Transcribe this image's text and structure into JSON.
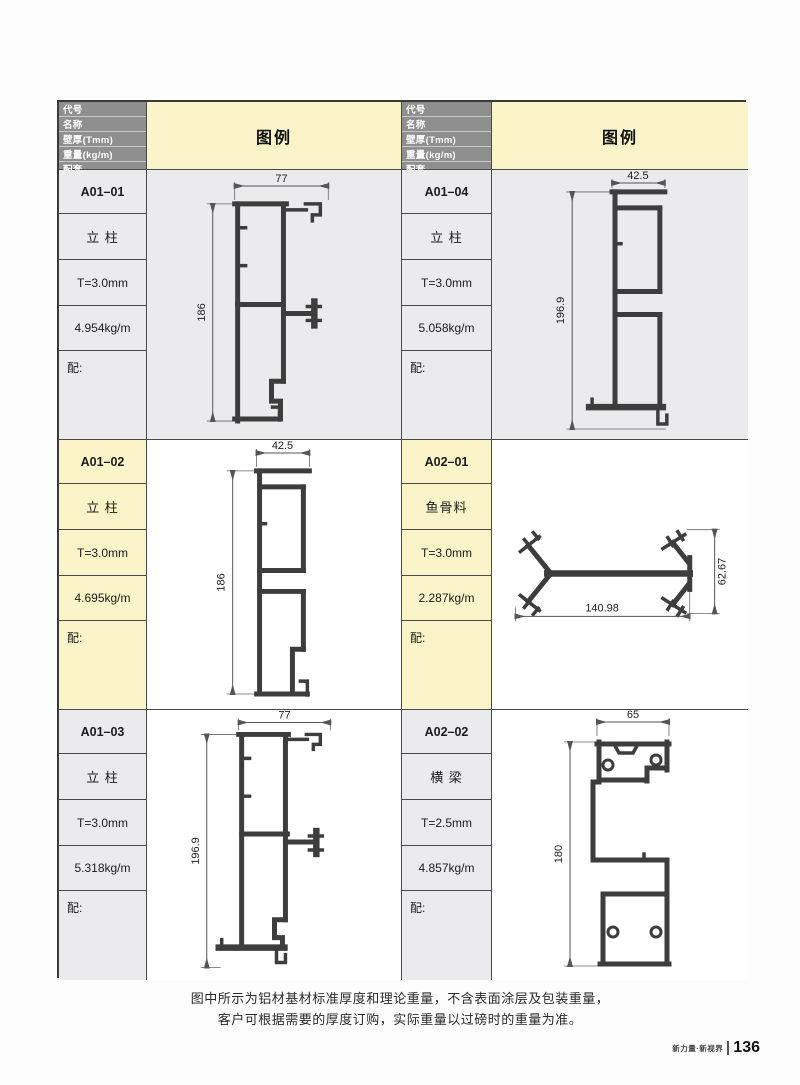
{
  "header": {
    "field_labels": [
      "代号",
      "名称",
      "壁厚(Tmm)",
      "重量(kg/m)",
      "配套"
    ],
    "legend_label": "图例"
  },
  "profiles": [
    {
      "code": "A01–01",
      "name": "立 柱",
      "thickness": "T=3.0mm",
      "weight": "4.954kg/m",
      "match_label": "配:",
      "dim_width": "77",
      "dim_height": "186"
    },
    {
      "code": "A01–04",
      "name": "立 柱",
      "thickness": "T=3.0mm",
      "weight": "5.058kg/m",
      "match_label": "配:",
      "dim_width": "42.5",
      "dim_height": "196.9"
    },
    {
      "code": "A01–02",
      "name": "立 柱",
      "thickness": "T=3.0mm",
      "weight": "4.695kg/m",
      "match_label": "配:",
      "dim_width": "42.5",
      "dim_height": "186"
    },
    {
      "code": "A02–01",
      "name": "鱼骨料",
      "thickness": "T=3.0mm",
      "weight": "2.287kg/m",
      "match_label": "配:",
      "dim_width": "140.98",
      "dim_height": "62.67"
    },
    {
      "code": "A01–03",
      "name": "立 柱",
      "thickness": "T=3.0mm",
      "weight": "5.318kg/m",
      "match_label": "配:",
      "dim_width": "77",
      "dim_height": "196.9"
    },
    {
      "code": "A02–02",
      "name": "横 梁",
      "thickness": "T=2.5mm",
      "weight": "4.857kg/m",
      "match_label": "配:",
      "dim_width": "65",
      "dim_height": "180"
    }
  ],
  "footer": {
    "note_line1": "图中所示为铝材基材标准厚度和理论重量，不含表面涂层及包装重量，",
    "note_line2": "客户可根据需要的厚度订购，实际重量以过磅时的重量为准。",
    "brand": "新力量·新视界",
    "page_number": "136"
  },
  "colors": {
    "header_gray": "#8f8f8f",
    "legend_yellow": "#faf4c8",
    "row_gray": "#ebebed",
    "profile_stroke": "#3d3d3d"
  }
}
